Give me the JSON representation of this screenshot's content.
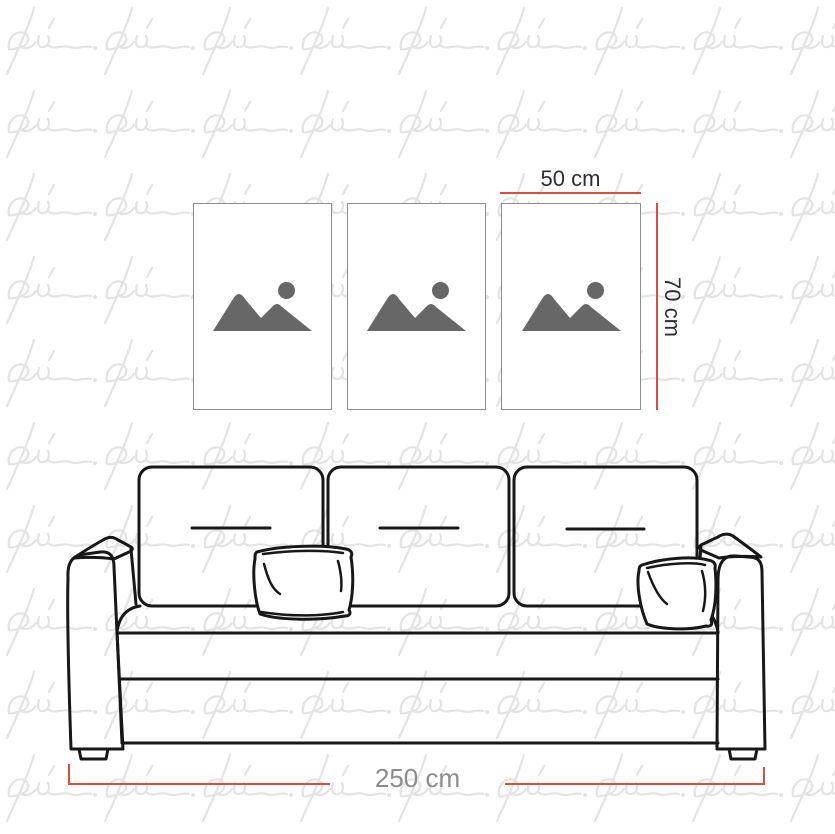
{
  "watermark": {
    "glyph_text": "pi",
    "color": "#e3e3e3"
  },
  "gallery": {
    "frames": [
      {
        "name": "frame-1",
        "icon": "image-placeholder-icon"
      },
      {
        "name": "frame-2",
        "icon": "image-placeholder-icon"
      },
      {
        "name": "frame-3",
        "icon": "image-placeholder-icon"
      }
    ],
    "frame_border_color": "#8d8d8d",
    "placeholder_icon_color": "#676767"
  },
  "annotations": {
    "frame_width_label": "50 cm",
    "frame_height_label": "70 cm",
    "sofa_width_label": "250 cm",
    "line_color": "#df4a41",
    "frame_label_color": "#2e2e2e",
    "sofa_label_color": "#8c8c8c"
  },
  "sofa": {
    "back_cushion_count": 3,
    "throw_pillow_count": 2,
    "outline_color": "#171717"
  }
}
